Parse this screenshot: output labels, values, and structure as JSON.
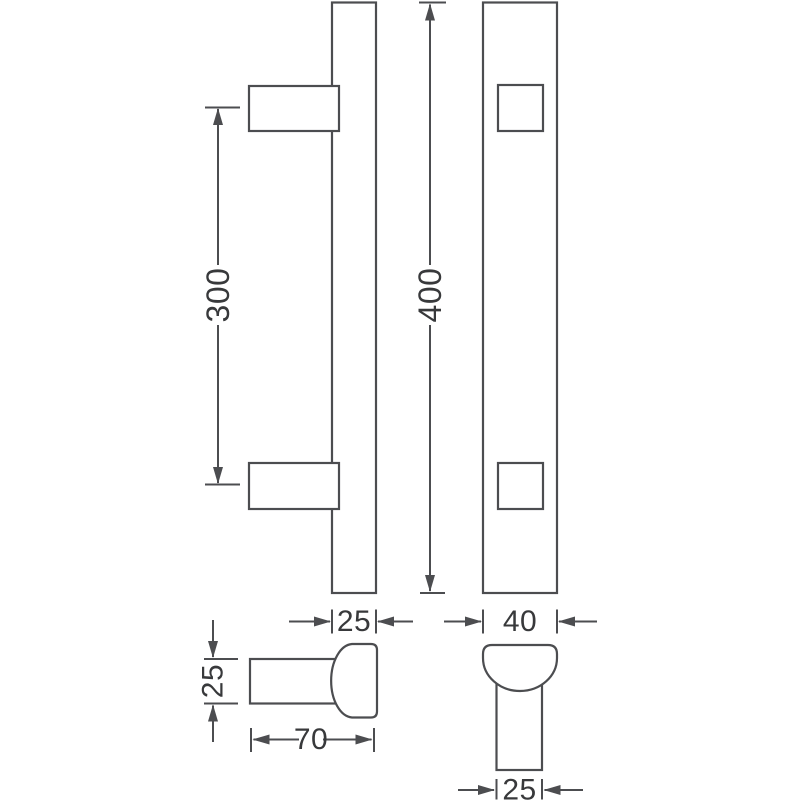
{
  "colors": {
    "background": "#ffffff",
    "line": "#4c4d50",
    "text": "#38393b"
  },
  "dimensions": {
    "fixing_centres": {
      "value": "300"
    },
    "overall_length": {
      "value": "400"
    },
    "bar_depth": {
      "value": "25"
    },
    "bar_width": {
      "value": "40"
    },
    "arm_height": {
      "value": "25"
    },
    "projection": {
      "value": "70"
    },
    "arm_width": {
      "value": "25"
    }
  }
}
